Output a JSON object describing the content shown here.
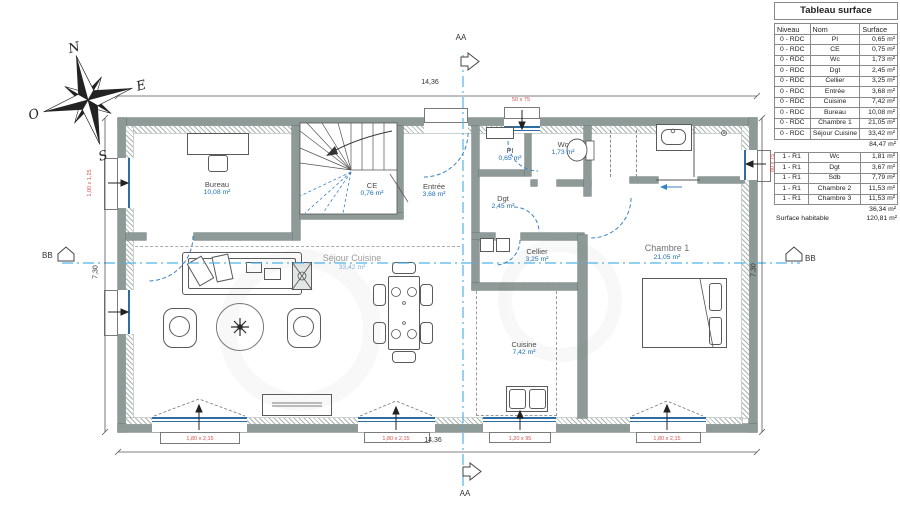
{
  "surface_table": {
    "title": "Tableau surface",
    "columns": [
      "Niveau",
      "Nom",
      "Surface"
    ],
    "rdc_rows": [
      [
        "0 - RDC",
        "PI",
        "0,65 m²"
      ],
      [
        "0 - RDC",
        "CE",
        "0,75 m²"
      ],
      [
        "0 - RDC",
        "Wc",
        "1,73 m²"
      ],
      [
        "0 - RDC",
        "Dgt",
        "2,45 m²"
      ],
      [
        "0 - RDC",
        "Cellier",
        "3,25 m²"
      ],
      [
        "0 - RDC",
        "Entrée",
        "3,68 m²"
      ],
      [
        "0 - RDC",
        "Cuisine",
        "7,42 m²"
      ],
      [
        "0 - RDC",
        "Bureau",
        "10,08 m²"
      ],
      [
        "0 - RDC",
        "Chambre 1",
        "21,05 m²"
      ],
      [
        "0 - RDC",
        "Séjour Cuisine",
        "33,42 m²"
      ]
    ],
    "rdc_total": "84,47 m²",
    "r1_rows": [
      [
        "1 - R1",
        "Wc",
        "1,81 m²"
      ],
      [
        "1 - R1",
        "Dgt",
        "3,67 m²"
      ],
      [
        "1 - R1",
        "Sdb",
        "7,79 m²"
      ],
      [
        "1 - R1",
        "Chambre 2",
        "11,53 m²"
      ],
      [
        "1 - R1",
        "Chambre 3",
        "11,53 m²"
      ]
    ],
    "r1_total": "36,34 m²",
    "habitable_label": "Surface habitable",
    "habitable_value": "120,81 m²"
  },
  "rooms": {
    "bureau": {
      "label": "Bureau",
      "area": "10,08 m²"
    },
    "entree": {
      "label": "Entrée",
      "area": "3,68 m²"
    },
    "pi": {
      "label": "PI",
      "area": "0,65 m²"
    },
    "wc": {
      "label": "Wc",
      "area": "1,73 m²"
    },
    "ce": {
      "label": "CE",
      "area": "0,76 m²"
    },
    "dgt": {
      "label": "Dgt",
      "area": "2,45 m²"
    },
    "sejour": {
      "label": "Séjour Cuisine",
      "area": "33,42 m²"
    },
    "cellier": {
      "label": "Cellier",
      "area": "3,25 m²"
    },
    "cuisine": {
      "label": "Cuisine",
      "area": "7,42 m²"
    },
    "chambre1": {
      "label": "Chambre 1",
      "area": "21,05 m²"
    }
  },
  "dimensions": {
    "top": "14,36",
    "bottom": "14,36",
    "left": "7,30",
    "right": "7,30"
  },
  "openings": {
    "top_window": "50 x 75",
    "left_window": "1,00 x 1,25",
    "right_window": "80 x 75",
    "bottom_window_1": "1,80 x 2,15",
    "bottom_window_2": "1,80 x 2,15",
    "bottom_window_3": "1,20 x 95",
    "bottom_window_4": "1,80 x 2,15"
  },
  "sections": {
    "vertical": "AA",
    "horizontal": "BB"
  },
  "compass": {
    "north": "N",
    "east": "E",
    "south": "S",
    "west": "O"
  },
  "colors": {
    "wall": "#8d9a97",
    "window_blue": "#2e6da4",
    "door_blue": "#3b82c4",
    "section_blue": "#4fb3e8",
    "area_blue": "#1d6fb8",
    "annotation_red": "#d9534f"
  }
}
